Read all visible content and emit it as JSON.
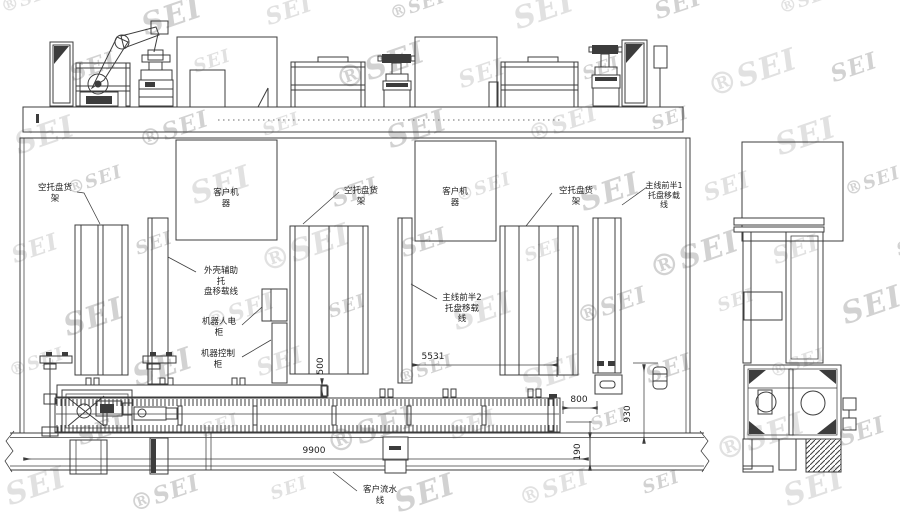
{
  "watermark": {
    "text": "SEI",
    "registered": "®"
  },
  "labels": {
    "empty_pallet_rack_1": [
      "空托盘货",
      "架"
    ],
    "empty_pallet_rack_2": [
      "空托盘货",
      "架"
    ],
    "empty_pallet_rack_3": [
      "空托盘货",
      "架"
    ],
    "customer_machine_1": [
      "客户机",
      "器"
    ],
    "customer_machine_2": [
      "客户机",
      "器"
    ],
    "shell_aux_line": [
      "外壳辅助",
      "托",
      "盘移载线"
    ],
    "robot_cabinet": [
      "机器人电",
      "柜"
    ],
    "machine_control_cabinet": [
      "机器控制",
      "柜"
    ],
    "mainline_front_half_2": [
      "主线前半2",
      "托盘移载",
      "线"
    ],
    "mainline_front_half_1": [
      "主线前半1",
      "托盘移载",
      "线"
    ],
    "customer_flow_line": [
      "客户流水",
      "线"
    ]
  },
  "dimensions": {
    "flow_line_length": "9900",
    "mainline_length": "5531",
    "rail_setback": "500",
    "end_clearance": "800",
    "band_width": "190",
    "side_span": "930"
  }
}
